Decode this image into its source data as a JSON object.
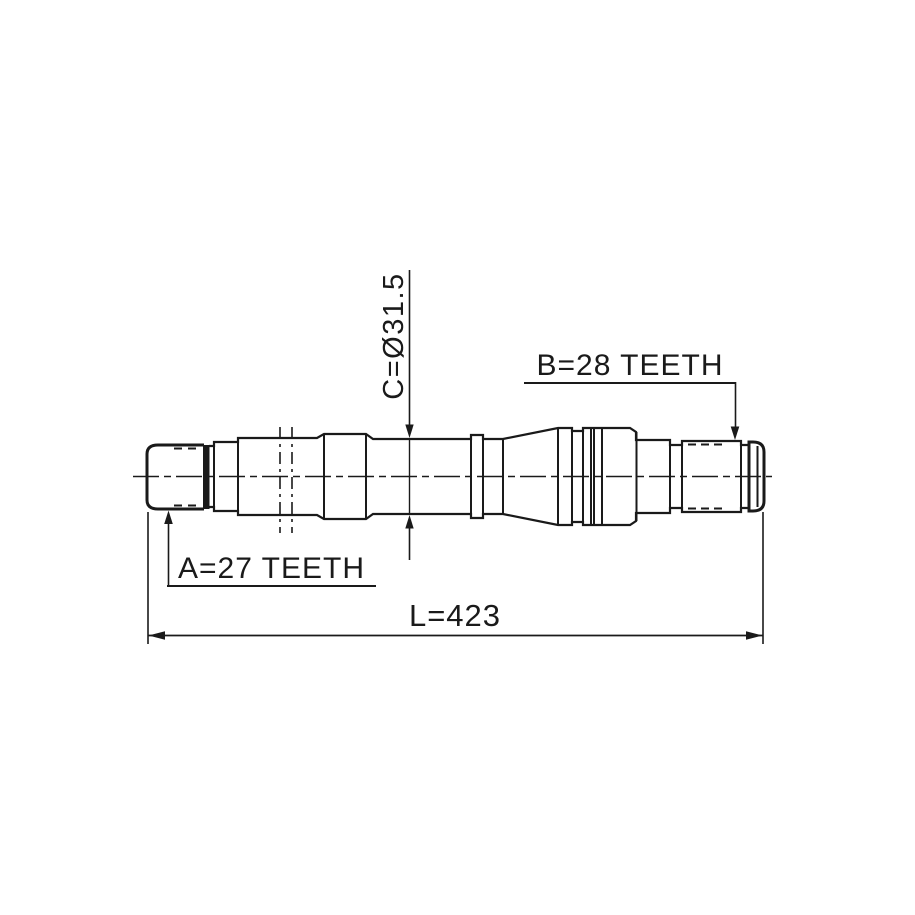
{
  "drawing": {
    "type": "engineering-part-drawing",
    "part": "drive shaft side view",
    "labels": {
      "a": "A=27 TEETH",
      "b": "B=28 TEETH",
      "c": "C=Ø31.5",
      "l": "L=423"
    },
    "values": {
      "a_teeth": 27,
      "b_teeth": 28,
      "c_diameter_mm": 31.5,
      "length_mm": 423
    },
    "colors": {
      "line": "#1a1a1a",
      "background": "#ffffff"
    }
  }
}
